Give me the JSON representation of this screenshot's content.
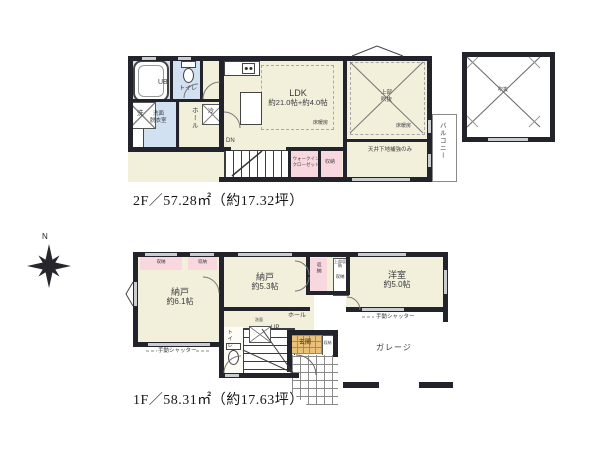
{
  "floor2": {
    "caption": "2F／57.28㎡（約17.32坪）",
    "labels": {
      "ub": "UB",
      "toilet": "トイレ",
      "wash_machine": "洗",
      "washroom_l1": "洗面",
      "washroom_l2": "脱衣室",
      "hall": "ホール",
      "fridge": "冷",
      "ldk": "LDK",
      "ldk_size": "約21.0帖+約4.0帖",
      "floor_heat_ldk": "床暖房",
      "floor_heat_room": "床暖房",
      "void_l1": "上部",
      "void_l2": "吹抜",
      "ceiling_note": "天井下地補強のみ",
      "dn": "DN",
      "wic_l1": "ウォークイン",
      "wic_l2": "クローゼット",
      "closet": "収納",
      "balcony": "バルコニー",
      "void_square": "吹抜"
    }
  },
  "floor1": {
    "caption": "1F／58.31㎡（約17.63坪）",
    "labels": {
      "closet_a": "収納",
      "closet_b": "収納",
      "nando1": "納戸",
      "nando1_size": "約6.1帖",
      "nando2": "納戸",
      "nando2_size": "約5.3帖",
      "yoshitsu": "洋室",
      "yoshitsu_size": "約5.0帖",
      "closet_v": "収納",
      "upper_closet": "上部収納",
      "closet_c": "収納",
      "hall": "ホール",
      "up": "UP",
      "toilet": "トイレ",
      "washstand": "洗面",
      "genkan": "玄関",
      "shoe_closet": "収納",
      "garage": "ガレージ",
      "shutter_left": "手動シャッター",
      "shutter_right": "手動シャッター"
    }
  },
  "compass": {
    "north": "N"
  },
  "colors": {
    "wall": "#23232b",
    "room_cream": "#f2efda",
    "wet_blue": "#d2e1f2",
    "closet_pink": "#f8d8de",
    "entry_tan": "#e9c178"
  }
}
